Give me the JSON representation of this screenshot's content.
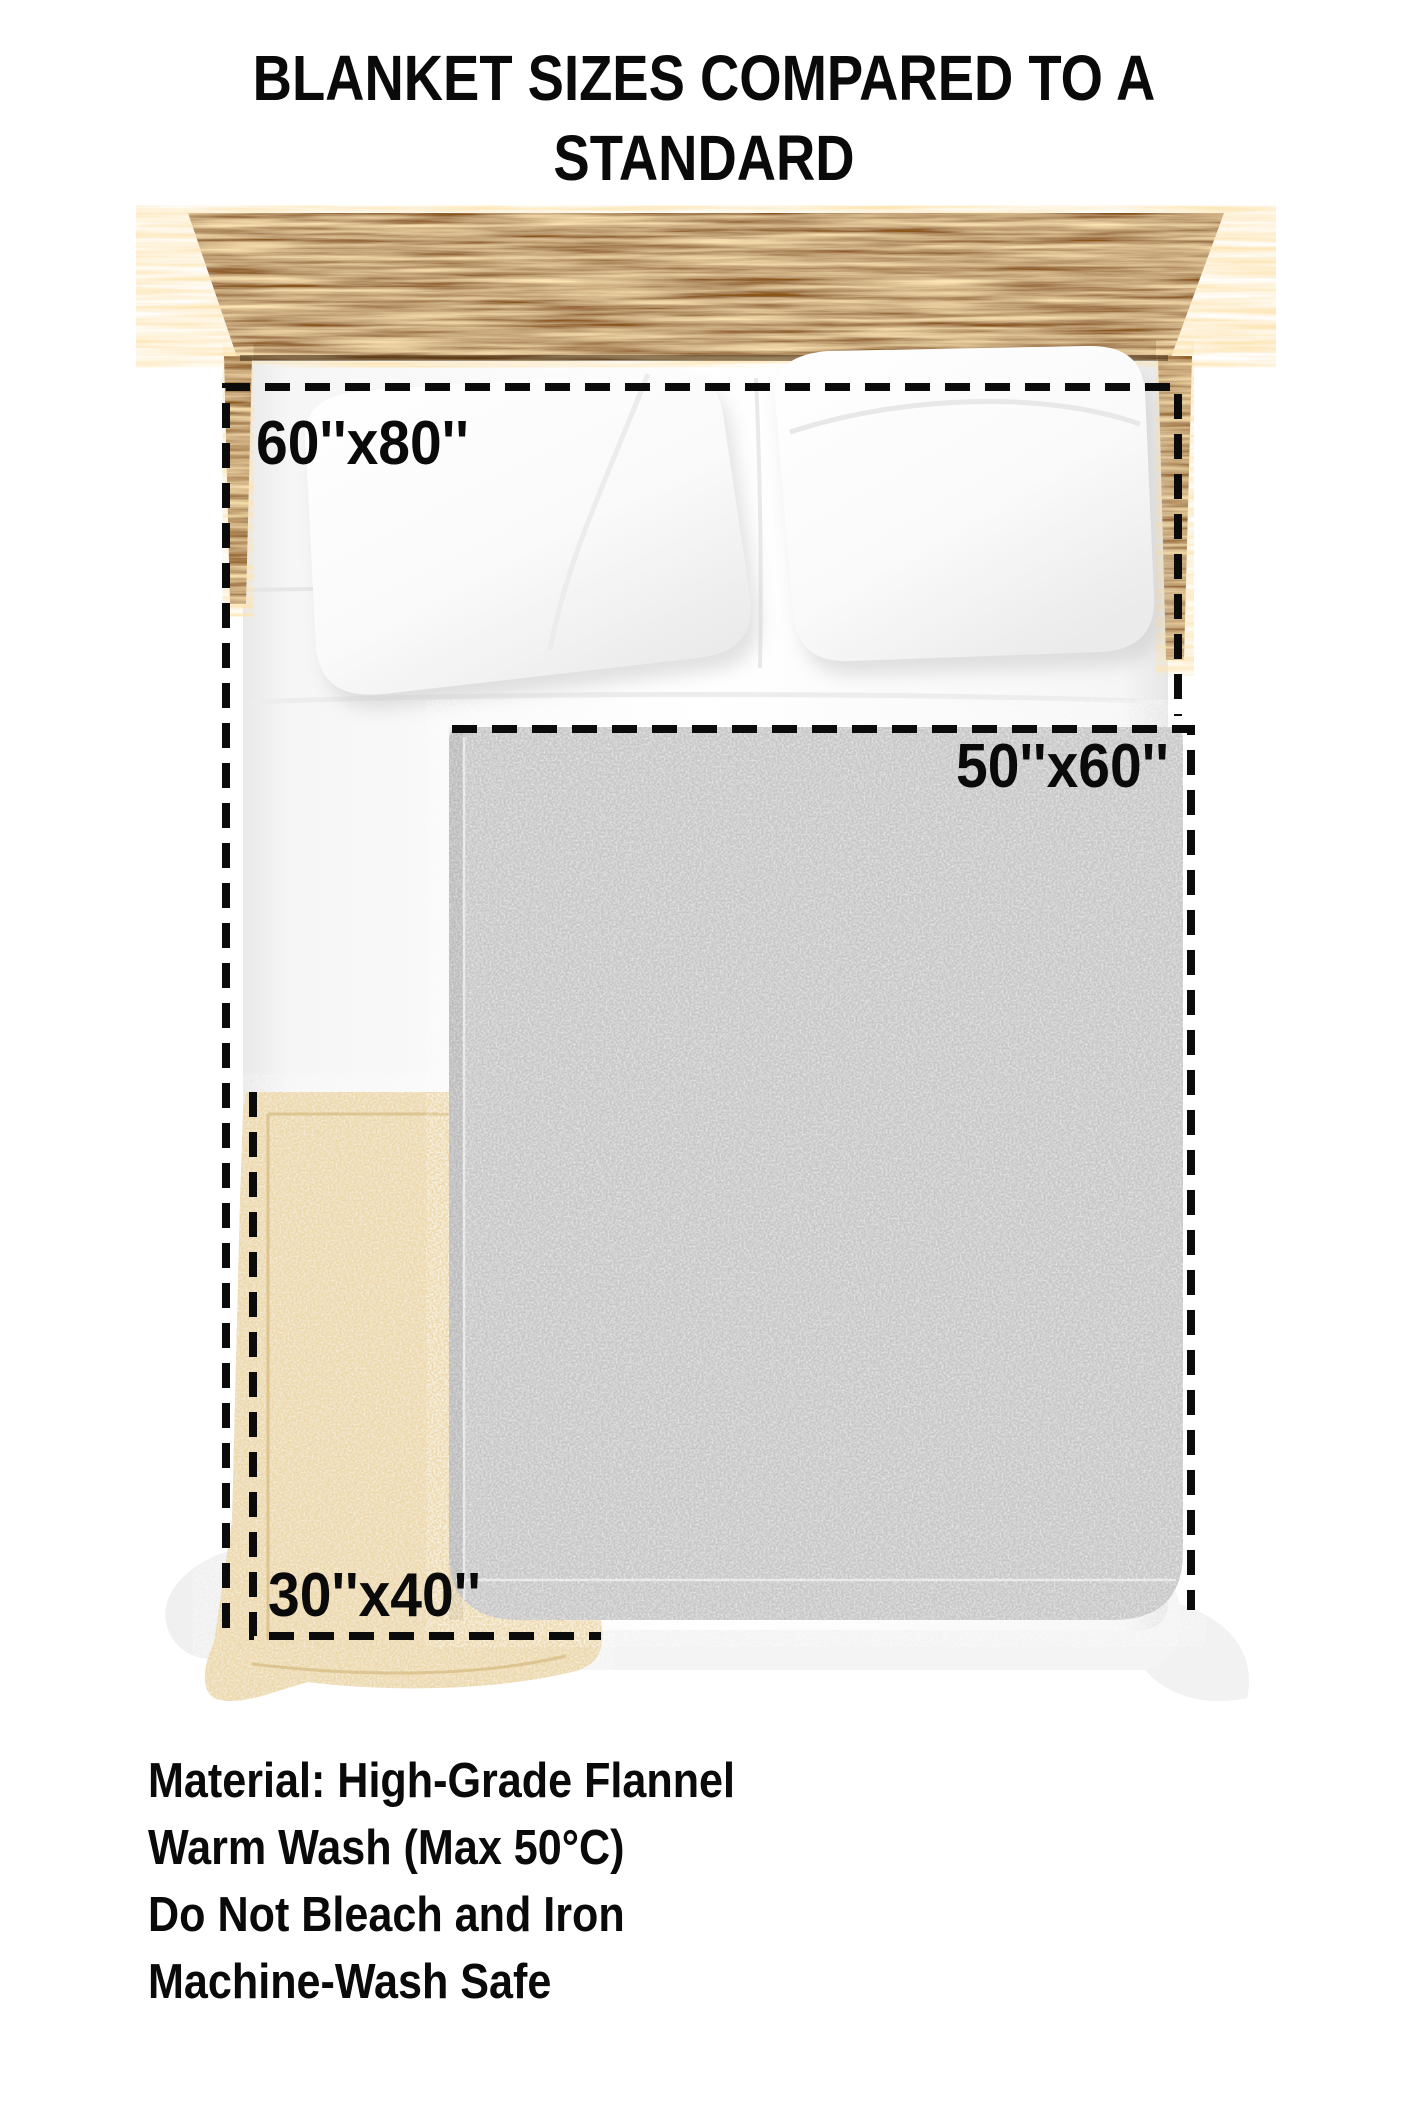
{
  "title": {
    "line1": "BLANKET SIZES COMPARED TO A STANDARD",
    "line2": "QUEEN SIZE BED"
  },
  "blankets": [
    {
      "id": "60x80",
      "label": "60''x80''"
    },
    {
      "id": "50x60",
      "label": "50''x60''"
    },
    {
      "id": "30x40",
      "label": "30''x40''"
    }
  ],
  "care": {
    "lines": [
      "Material: High-Grade Flannel",
      "Warm Wash (Max 50°C)",
      "Do Not Bleach and Iron",
      "Machine-Wash Safe"
    ]
  },
  "colors": {
    "outline": "#0b0b0b",
    "wood": "#8a5418",
    "wood_post": "#915d1d",
    "blanket_50x60": "#c6c6c7",
    "blanket_30x40": "#ecd8ab",
    "mattress": "#f8f8f8"
  }
}
